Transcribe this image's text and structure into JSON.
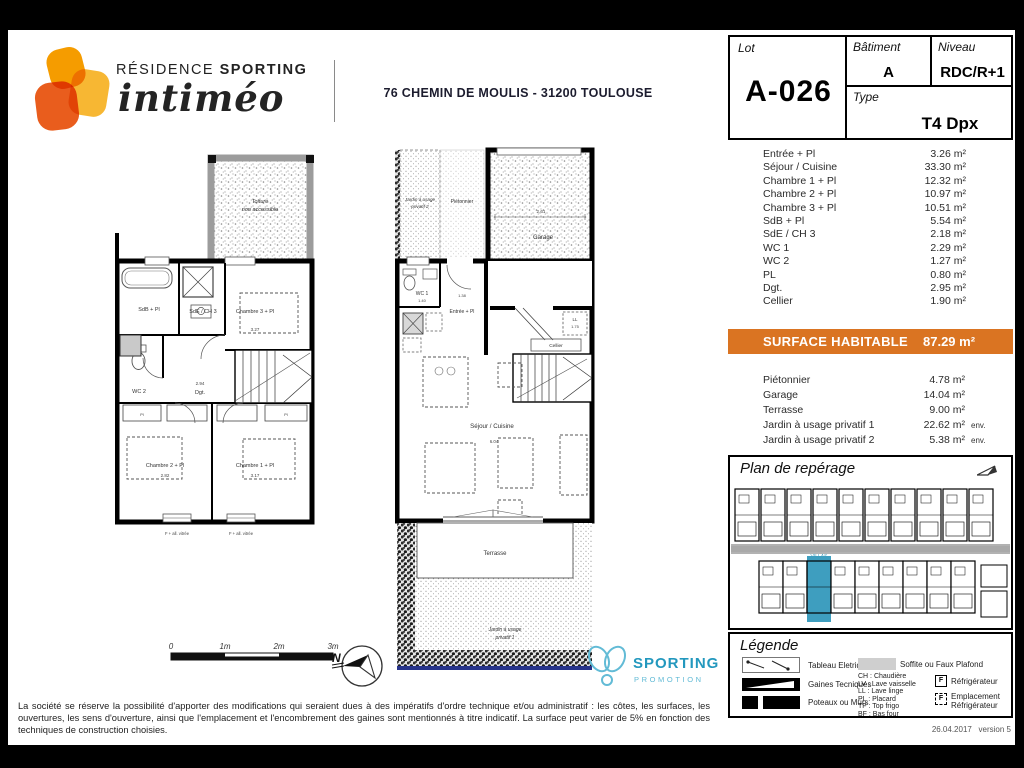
{
  "colors": {
    "orange": "#DA7422",
    "blue": "#3E9EBF",
    "teal": "#2398BE",
    "teal2": "#62BBD6"
  },
  "header": {
    "brand_residence": "RÉSIDENCE",
    "brand_sporting": "SPORTING",
    "brand_name": "intiméo",
    "address": "76 CHEMIN DE MOULIS - 31200 TOULOUSE"
  },
  "info_card": {
    "lot_label": "Lot",
    "lot_value": "A-026",
    "batiment_label": "Bâtiment",
    "batiment_value": "A",
    "niveau_label": "Niveau",
    "niveau_value": "RDC/R+1",
    "type_label": "Type",
    "type_value": "T4 Dpx"
  },
  "rooms": [
    {
      "label": "Entrée + Pl",
      "area": "3.26 m²"
    },
    {
      "label": "Séjour / Cuisine",
      "area": "33.30 m²"
    },
    {
      "label": "Chambre 1 + Pl",
      "area": "12.32 m²"
    },
    {
      "label": "Chambre 2 + Pl",
      "area": "10.97 m²"
    },
    {
      "label": "Chambre 3 + Pl",
      "area": "10.51 m²"
    },
    {
      "label": "SdB + Pl",
      "area": "5.54 m²"
    },
    {
      "label": "SdE / CH 3",
      "area": "2.18 m²"
    },
    {
      "label": "WC 1",
      "area": "2.29 m²"
    },
    {
      "label": "WC 2",
      "area": "1.27 m²"
    },
    {
      "label": "PL",
      "area": "0.80 m²"
    },
    {
      "label": "Dgt.",
      "area": "2.95 m²"
    },
    {
      "label": "Cellier",
      "area": "1.90 m²"
    }
  ],
  "surface": {
    "label": "SURFACE HABITABLE",
    "value": "87.29 m²"
  },
  "annexes": [
    {
      "label": "Piétonnier",
      "value": "4.78 m²",
      "suffix": ""
    },
    {
      "label": "Garage",
      "value": "14.04 m²",
      "suffix": ""
    },
    {
      "label": "Terrasse",
      "value": "9.00 m²",
      "suffix": ""
    },
    {
      "label": "Jardin à usage privatif 1",
      "value": "22.62 m²",
      "suffix": "env."
    },
    {
      "label": "Jardin à usage privatif 2",
      "value": "5.38 m²",
      "suffix": "env."
    }
  ],
  "plan_left": {
    "labels": {
      "toiture_line1": "Toiture",
      "toiture_line2": "non accessible",
      "sdb": "SdB + Pl",
      "sde": "SdE / CH 3",
      "ch3": "Chambre 3 + Pl",
      "wc2": "WC 2",
      "dgt": "Dgt.",
      "ch2": "Chambre 2 + Pl",
      "ch1": "Chambre 1 + Pl",
      "pl": "Pl",
      "window": "F + all. vitrée"
    },
    "dims": {
      "ch3": "3.27",
      "dgt": "2.94",
      "ch2": "2.82",
      "ch1": "3.17"
    }
  },
  "plan_right": {
    "labels": {
      "jardin2_line1": "Jardin à usage",
      "jardin2_line2": "privatif 2",
      "pietonnier": "Piétonnier",
      "garage": "Garage",
      "wc1": "WC 1",
      "entree": "Entrée + Pl",
      "cellier": "Cellier",
      "ll": "LL",
      "sejour": "Séjour / Cuisine",
      "terrasse": "Terrasse",
      "jardin1_line1": "Jardin à usage",
      "jardin1_line2": "privatif 1"
    },
    "dims": {
      "garage": "2.61",
      "wc1": "1.40",
      "entree": "1.38",
      "ll": "1.75",
      "sejour": "6.04"
    }
  },
  "reperage": {
    "title": "Plan de repérage",
    "villas": "VILLAS"
  },
  "legende": {
    "title": "Légende",
    "tableau": "Tableau Eletrique",
    "gaines": "Gaines Tecniques",
    "poteaux": "Poteaux ou Murs",
    "soffite": "Soffite ou Faux Plafond",
    "abbr": [
      "CH : Chaudière",
      "LV : Lave vaisselle",
      "LL : Lave linge",
      "PL : Placard",
      "TF : Top frigo",
      "BF : Bas four"
    ],
    "f": "F",
    "refrigerateur": "Réfrigérateur",
    "emplacement": "Emplacement Réfrigérateur"
  },
  "scalebar": {
    "t0": "0",
    "t1": "1m",
    "t2": "2m",
    "t3": "3m"
  },
  "north": {
    "label": "N"
  },
  "promotion": {
    "name": "SPORTING",
    "sub": "PROMOTION"
  },
  "footer": {
    "disclaimer": "La société se réserve la possibilité d'apporter des modifications qui seraient dues à des impératifs d'ordre technique et/ou administratif : les côtes, les surfaces, les ouvertures, les sens d'ouverture, ainsi que l'emplacement et l'encombrement des gaines sont mentionnés à titre indicatif. La surface peut varier de 5% en fonction des techniques de construction choisies.",
    "date": "26.04.2017",
    "version": "version 5"
  }
}
